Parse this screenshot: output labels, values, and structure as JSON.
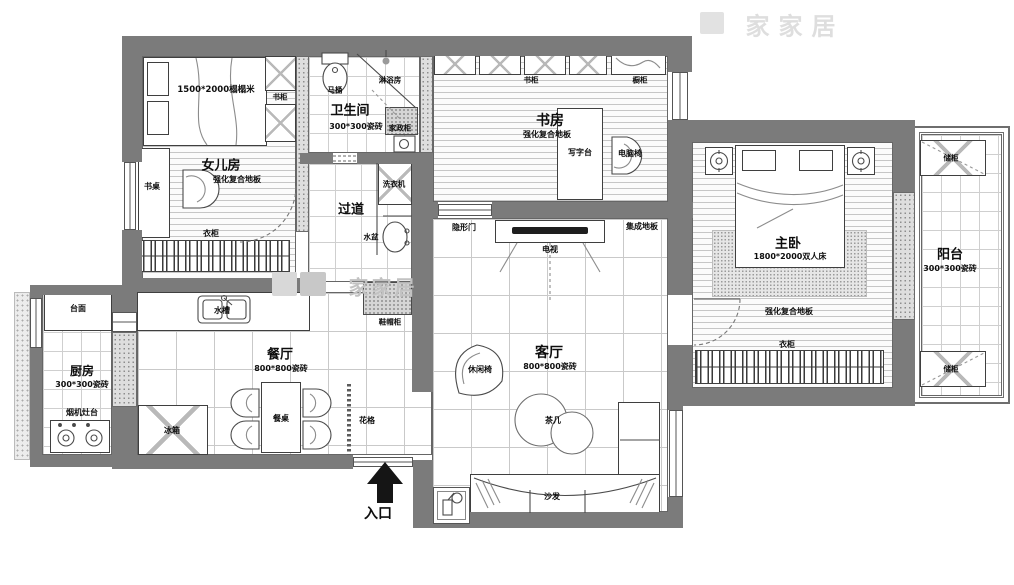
{
  "title": "apartment-floor-plan",
  "watermark": {
    "text": "家家居"
  },
  "colors": {
    "wall": "#7b7b7b",
    "line": "#3f3f3f",
    "speckle": "#dedede"
  },
  "rooms": {
    "daughter": {
      "name": "女儿房",
      "floor": "强化复合地板",
      "furniture": {
        "bed": "1500*2000榻榻米",
        "bookcase": "书柜",
        "desk": "书桌",
        "wardrobe": "衣柜"
      }
    },
    "bathroom": {
      "name": "卫生间",
      "floor": "300*300瓷砖",
      "furniture": {
        "toilet": "马桶",
        "shower": "淋浴房",
        "utility_cabinet": "家政柜"
      }
    },
    "hallway": {
      "name": "过道",
      "furniture": {
        "washer": "洗衣机",
        "basin": "水盆",
        "shoe_cabinet": "鞋帽柜"
      }
    },
    "study": {
      "name": "书房",
      "floor": "强化复合地板",
      "furniture": {
        "bookcase": "书柜",
        "cabinet": "橱柜",
        "writing_desk": "写字台",
        "computer_chair": "电脑椅"
      }
    },
    "master": {
      "name": "主卧",
      "floor": "强化复合地板",
      "furniture": {
        "bed": "1800*2000双人床",
        "wardrobe": "衣柜"
      }
    },
    "balcony": {
      "name": "阳台",
      "floor": "300*300瓷砖",
      "furniture": {
        "storage_top": "储柜",
        "storage_bottom": "储柜"
      }
    },
    "kitchen": {
      "name": "厨房",
      "floor": "300*300瓷砖",
      "furniture": {
        "countertop": "台面",
        "hood_stove": "烟机灶台"
      }
    },
    "dining": {
      "name": "餐厅",
      "floor": "800*800瓷砖",
      "furniture": {
        "sink": "水槽",
        "fridge": "冰箱",
        "table": "餐桌",
        "lattice": "花格"
      }
    },
    "living": {
      "name": "客厅",
      "floor": "800*800瓷砖",
      "furniture": {
        "hidden_door": "隐形门",
        "tv": "电视",
        "integrated_floor": "集成地板",
        "leisure_chair": "休闲椅",
        "tea_table": "茶几",
        "sofa": "沙发"
      }
    },
    "entrance": {
      "name": "入口"
    }
  }
}
